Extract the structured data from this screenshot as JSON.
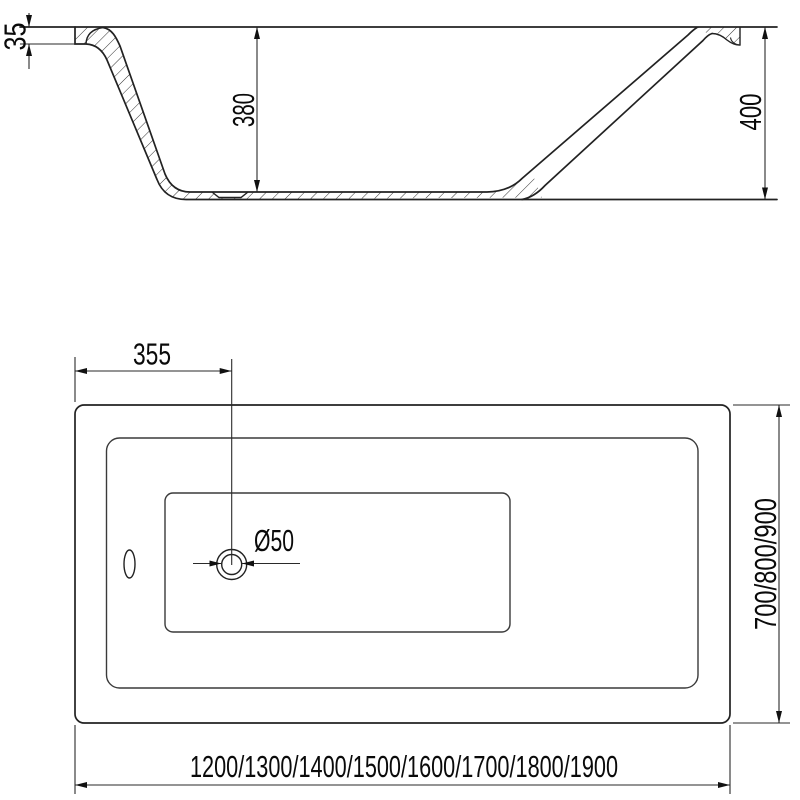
{
  "drawing": {
    "side_view": {
      "rim_height_label": "35",
      "depth_label": "380",
      "height_label": "400"
    },
    "plan_view": {
      "drain_offset_label": "355",
      "drain_diameter_label": "Ø50",
      "width_options_label": "700/800/900",
      "length_options_label": "1200/1300/1400/1500/1600/1700/1800/1900"
    }
  }
}
